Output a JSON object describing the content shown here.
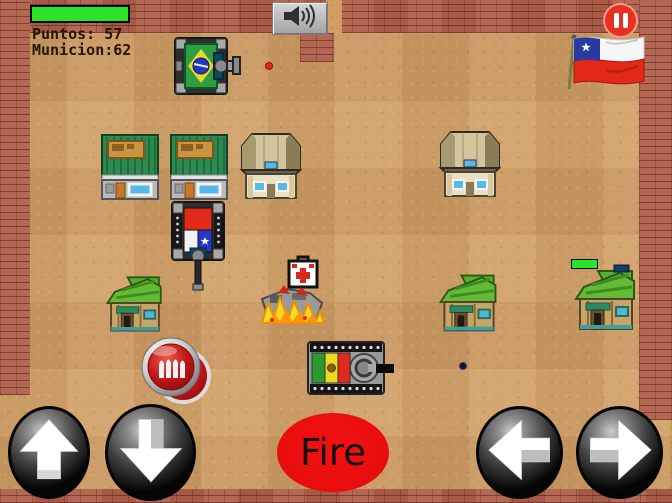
{
  "hud": {
    "health_bar": {
      "percent_full": 100
    },
    "score_label": "Puntos: 57",
    "ammo_label": "Municion:62"
  },
  "topbar": {
    "sound_icon": "speaker-icon",
    "pause_icon": "pause-icon",
    "flag_banner": "chile-flag"
  },
  "controls": {
    "fire_label": "Fire",
    "up_icon": "arrow-up-icon",
    "down_icon": "arrow-down-icon",
    "left_icon": "arrow-left-icon",
    "right_icon": "arrow-right-icon"
  },
  "colors": {
    "health_green": "#2be32b",
    "pause_red": "#e83020",
    "fire_red": "#f31111",
    "fire_text": "#111111",
    "ground_sand": "#d09d63",
    "brick_red": "#b0604a",
    "hud_text": "#241505"
  },
  "entities": {
    "player_tank": "brazil-flag-tank",
    "enemy_tanks": [
      "chile-flag-tank",
      "bolivia-flag-tank"
    ],
    "destroyed_tank": "burning-tank-explosion",
    "pickups": [
      "ammo-bullets-pickup",
      "medkit-pickup"
    ],
    "projectiles": [
      "red-bullet",
      "dark-bullet"
    ],
    "buildings": [
      "green-mart",
      "green-mart",
      "tan-house",
      "tan-house",
      "green-house",
      "green-house",
      "green-house"
    ],
    "decorations": [
      "chile-flag-banner",
      "enemy-health-bar"
    ]
  }
}
